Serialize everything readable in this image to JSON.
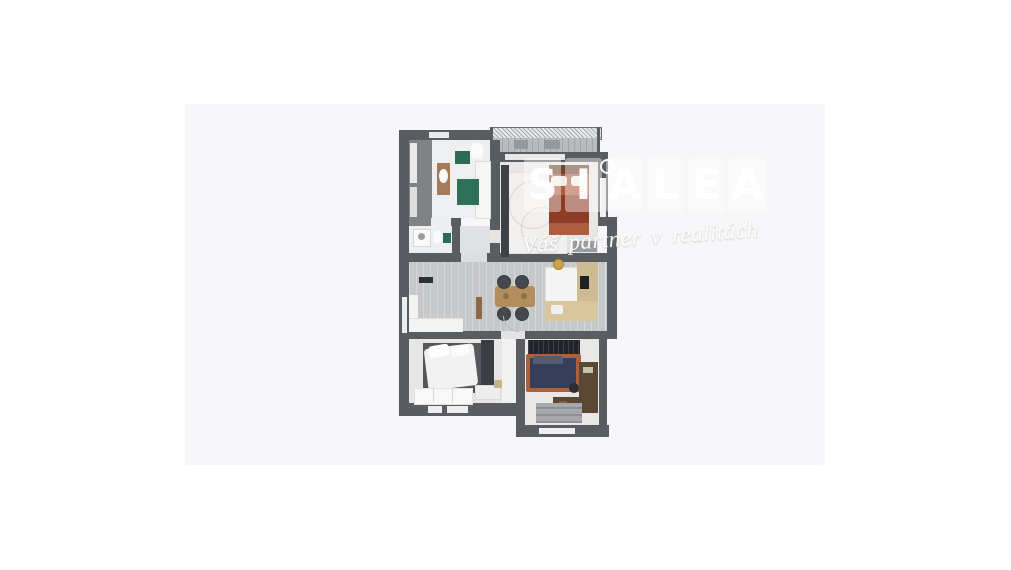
{
  "canvas": {
    "background": "#ffffff",
    "photo_background": "#f7f7f9"
  },
  "watermark": {
    "letters": [
      "S",
      "I",
      "A",
      "L",
      "E",
      "A"
    ],
    "tagline": "Váš partner v realitách",
    "color": "#ffffff"
  },
  "floorplan": {
    "type": "apartment-3d-top-down-render",
    "wall_color": "#595c60",
    "palette": {
      "floor_light": "#e8e6e3",
      "floor_tile": "#edeff1",
      "floor_wood_gray": "#c7c8ca",
      "terracotta_bed": "#b05c3e",
      "terracotta_blanket": "#8d3c27",
      "navy_duvet": "#363e5a",
      "green_mat": "#2c6b55",
      "kitchen_beige": "#d9c69c",
      "table_wood": "#b28e5e",
      "desk_brown": "#5a4734",
      "curtain_dark": "#212329",
      "wardrobe_dark": "#3a3d42"
    },
    "rooms": [
      {
        "name": "balcony",
        "furniture": [
          "railing",
          "lounge-chairs"
        ]
      },
      {
        "name": "hallway",
        "furniture": [
          "closet"
        ]
      },
      {
        "name": "bathroom",
        "furniture": [
          "vanity-sink",
          "toilet",
          "bathtub",
          "green-mats"
        ]
      },
      {
        "name": "wc",
        "furniture": [
          "washing-machine",
          "toilet",
          "green-mat"
        ]
      },
      {
        "name": "bedroom-top",
        "furniture": [
          "terracotta-bed",
          "wardrobe",
          "swirl-rug",
          "dresser"
        ]
      },
      {
        "name": "living-dining-kitchen",
        "furniture": [
          "sofa",
          "tv-unit",
          "dining-table",
          "chairs",
          "kitchen-units",
          "counter",
          "pendant-light"
        ]
      },
      {
        "name": "bedroom-left",
        "furniture": [
          "bed-white-duvet",
          "wardrobe",
          "dresser",
          "basket"
        ]
      },
      {
        "name": "bedroom-right",
        "furniture": [
          "navy-bed",
          "curtains",
          "desk",
          "rug"
        ]
      }
    ]
  }
}
